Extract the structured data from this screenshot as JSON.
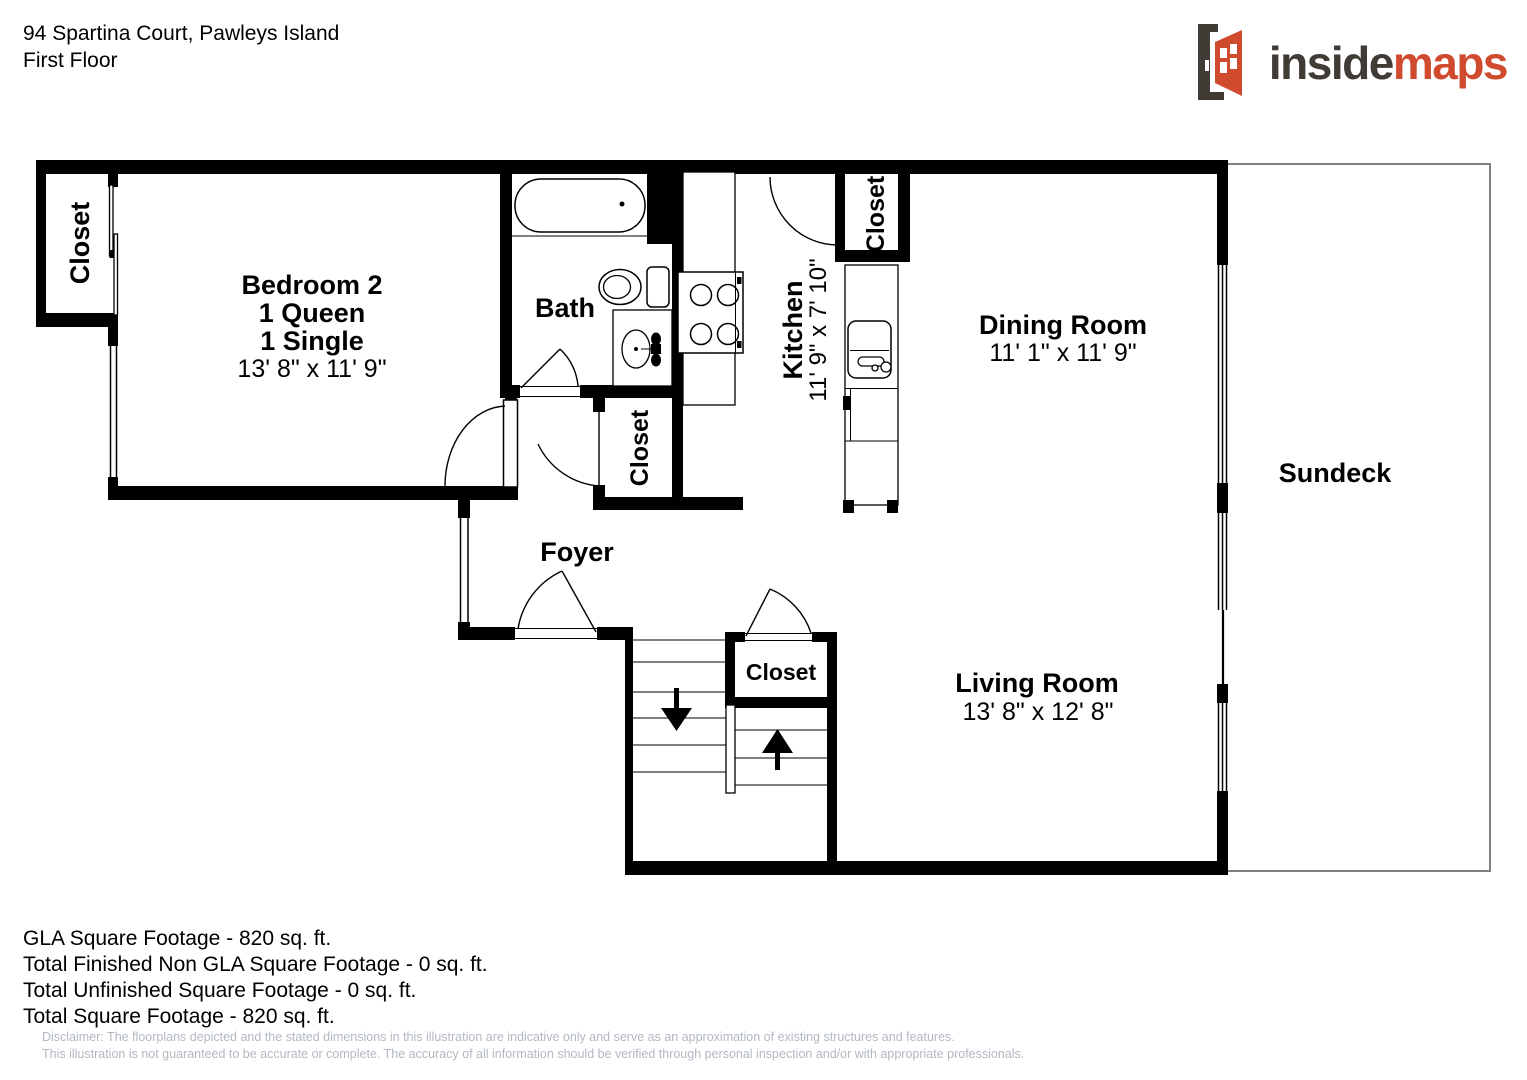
{
  "header": {
    "address": "94 Spartina Court, Pawleys Island",
    "floor": "First Floor"
  },
  "logo": {
    "brand_prefix": "inside",
    "brand_suffix": "maps",
    "door_icon": "open-door-icon",
    "colors": {
      "dark": "#413b36",
      "red": "#d04a2d"
    }
  },
  "rooms": {
    "bedroom2": {
      "name": "Bedroom 2",
      "line2": "1 Queen",
      "line3": "1 Single",
      "dims": "13' 8\" x 11' 9\""
    },
    "bath": {
      "name": "Bath"
    },
    "kitchen": {
      "name": "Kitchen",
      "dims": "11' 9\" x 7' 10\""
    },
    "dining": {
      "name": "Dining Room",
      "dims": "11' 1\" x 11' 9\""
    },
    "living": {
      "name": "Living Room",
      "dims": "13' 8\" x 12' 8\""
    },
    "foyer": {
      "name": "Foyer"
    },
    "sundeck": {
      "name": "Sundeck"
    },
    "closet_bedroom": {
      "name": "Closet"
    },
    "closet_hall": {
      "name": "Closet"
    },
    "closet_kitchen": {
      "name": "Closet"
    },
    "closet_stairs": {
      "name": "Closet"
    }
  },
  "footer": {
    "lines": [
      "GLA Square Footage - 820 sq. ft.",
      "Total Finished Non GLA Square Footage - 0 sq. ft.",
      "Total Unfinished Square Footage - 0 sq. ft.",
      "Total Square Footage - 820 sq. ft."
    ],
    "disclaimer_line1": "Disclaimer: The floorplans depicted and the stated dimensions in this illustration are indicative only and serve as an approximation of existing structures and features.",
    "disclaimer_line2": "This illustration is not guaranteed to be accurate or complete. The accuracy of all information should be verified through personal inspection and/or with appropriate professionals."
  },
  "colors": {
    "walls": "#000000",
    "sundeck_outline": "#808080",
    "disclaimer_text": "#b2b8c2"
  }
}
